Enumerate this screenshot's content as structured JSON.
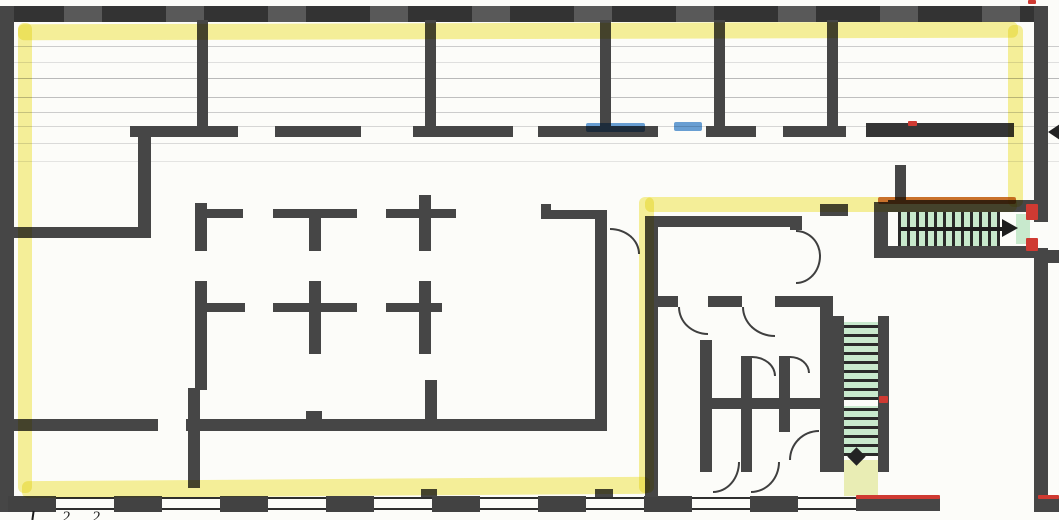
{
  "annotations": {
    "bottom_left_partial_text": "2 2"
  },
  "icons": {
    "upper_stair_direction": "arrow-right-icon",
    "lower_stair_direction": "arrow-down-icon",
    "right_edge_marker": "arrow-left-icon"
  },
  "colors": {
    "paper": "#fcfcf9",
    "wall_dark": "#464646",
    "wall_darker": "#353535",
    "highlight_yellow": "#f3e95e",
    "stair_green": "#c8e9cd",
    "stair_tread_line": "#2a2a2a",
    "landing_green": "#e9edb4",
    "mark_blue": "#4e8fd0",
    "mark_orange": "#cf6a31",
    "mark_red": "#cf3a32",
    "scan_line_gray": "#cccccc"
  }
}
